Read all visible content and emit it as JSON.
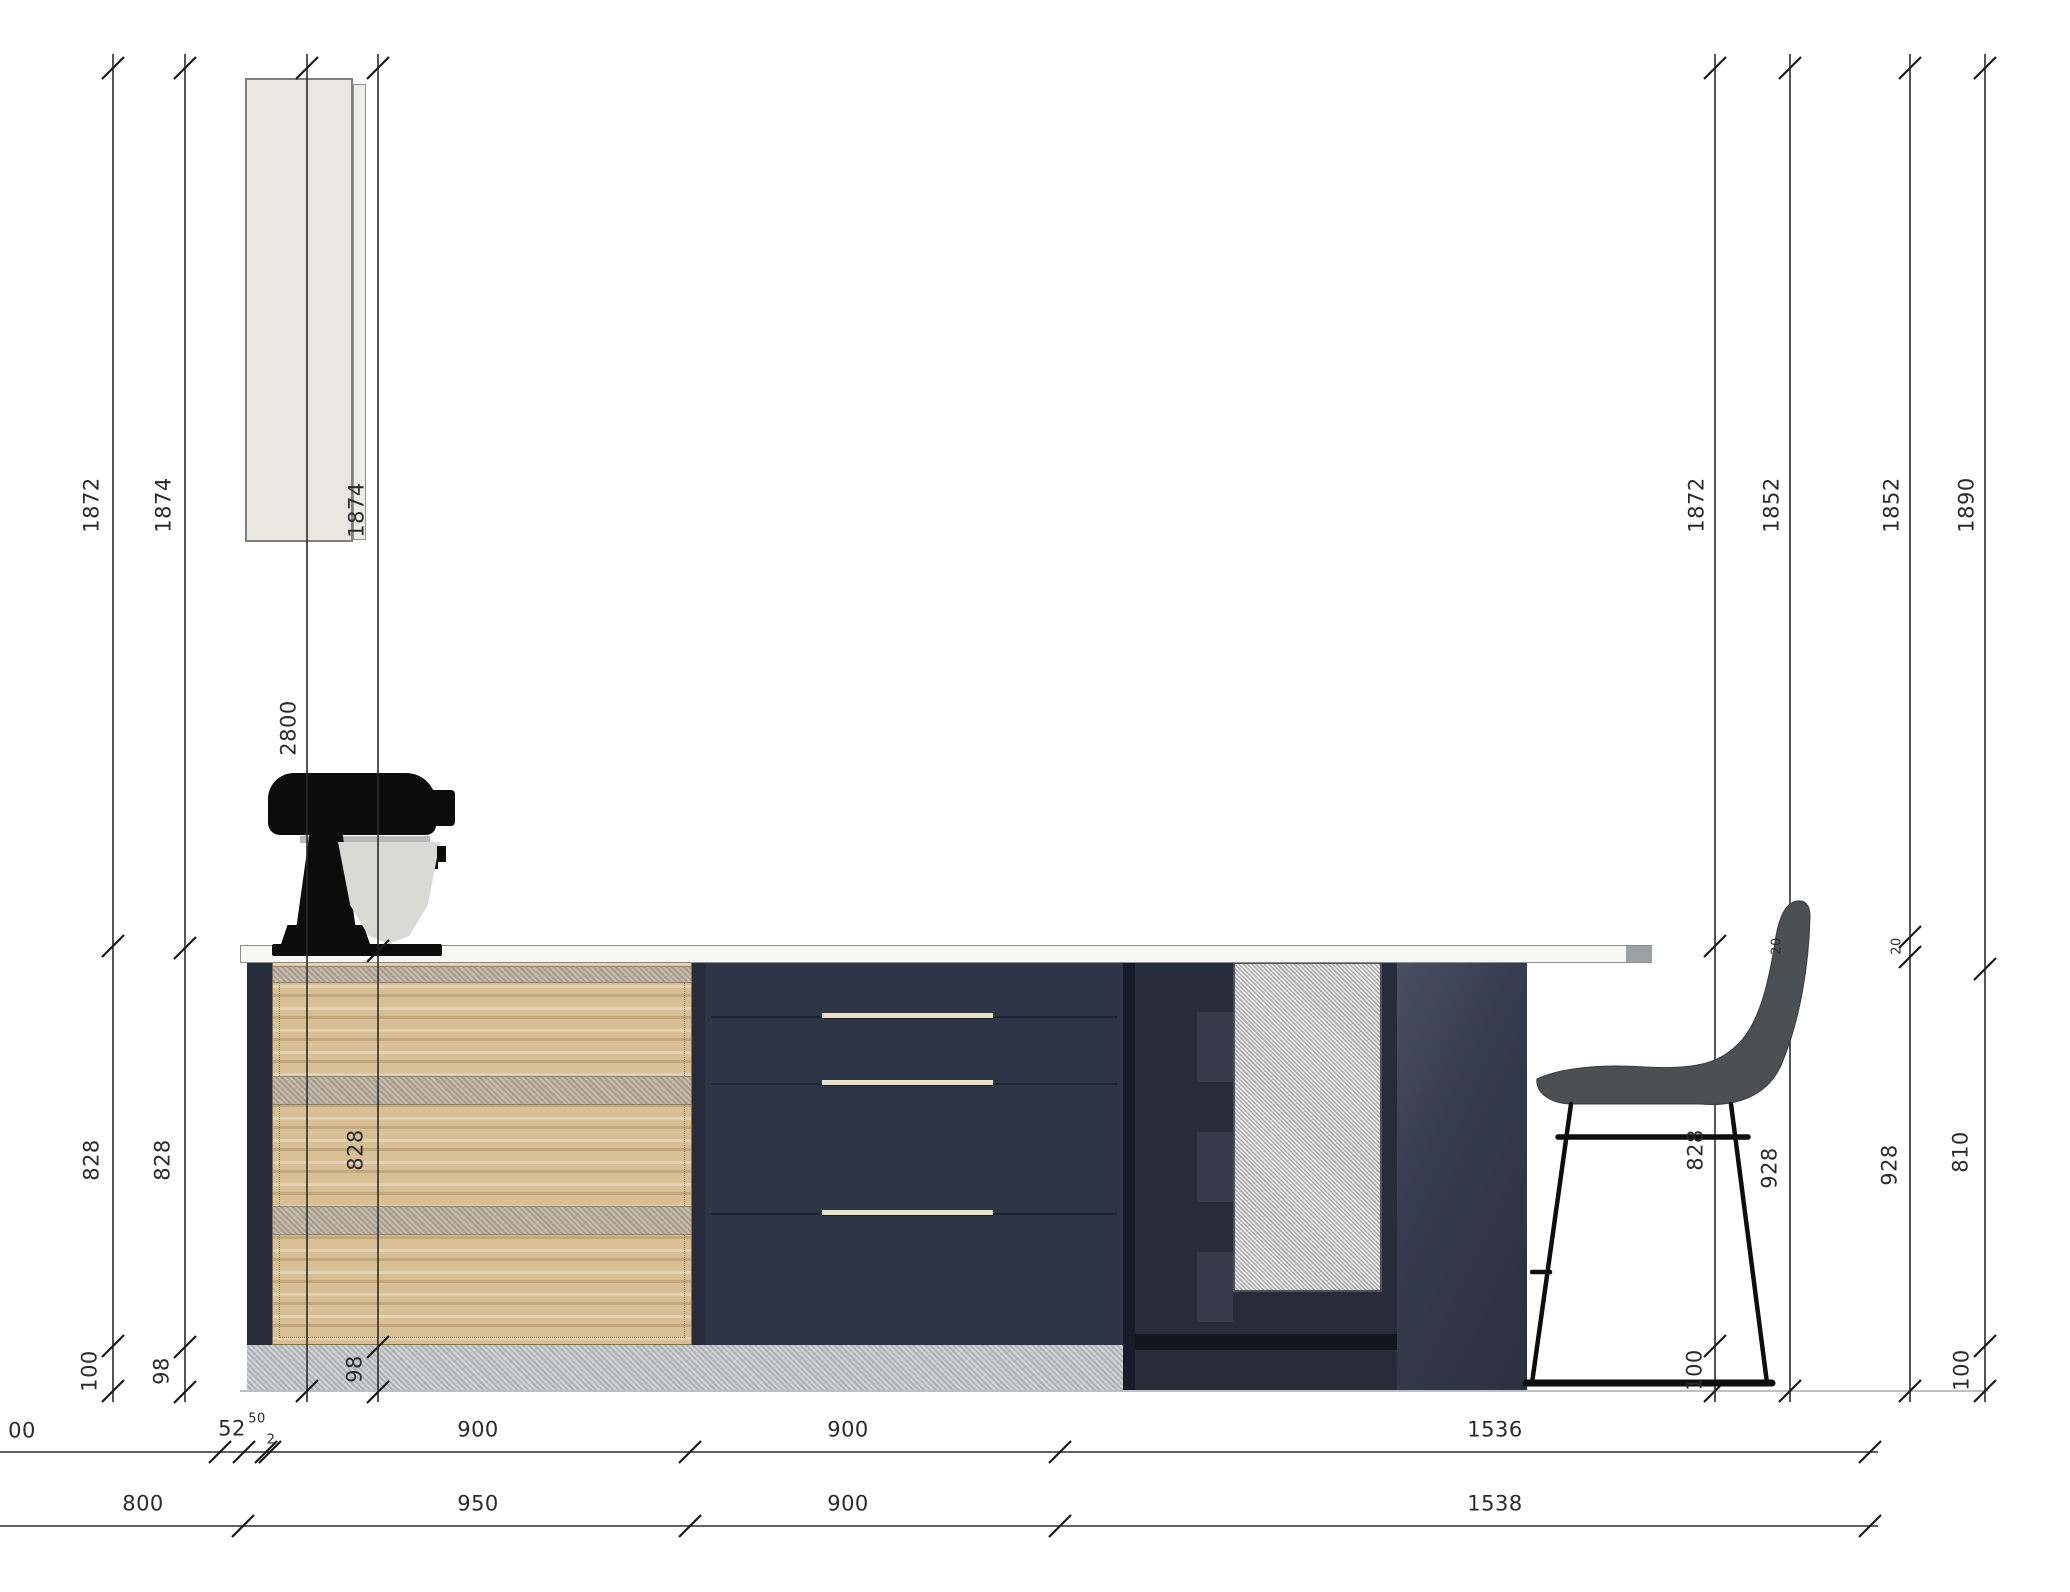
{
  "document": {
    "type": "kitchen-island-elevation-drawing",
    "view": "side-elevation"
  },
  "colors": {
    "cabinet_navy": "#2e3546",
    "wood_front": "#d8c094",
    "countertop": "#f7f7f4",
    "plinth_gray": "#b8bbbe",
    "mesh_panel": "#c8c8c8",
    "wall_unit": "#e8e8e1",
    "dimension_ink": "#2b2b2b"
  },
  "objects": {
    "wall_cabinet": "tall wall cabinet",
    "appliance": "stand mixer",
    "seating": "bar stool",
    "fronts": [
      "wood drawer front",
      "navy drawer stack",
      "mesh cabinet door",
      "end panel"
    ]
  },
  "structure": {
    "vertical_chains_left": [
      [
        "1872",
        "828",
        "100"
      ],
      [
        "1874",
        "828",
        "98"
      ],
      [
        "2800"
      ],
      [
        "1874",
        "828",
        "98"
      ]
    ],
    "vertical_chains_right": [
      [
        "1872",
        "828",
        "100"
      ],
      [
        "1852",
        "20",
        "928"
      ],
      [
        "1852",
        "20",
        "928"
      ],
      [
        "1890",
        "810",
        "100"
      ]
    ],
    "horizontal_rows": [
      [
        "00",
        "52",
        "50",
        "2",
        "900",
        "900",
        "1536"
      ],
      [
        "800",
        "950",
        "900",
        "1538"
      ]
    ]
  },
  "dim_labels": [
    {
      "text": "1872"
    },
    {
      "text": "828"
    },
    {
      "text": "100"
    },
    {
      "text": "1874"
    },
    {
      "text": "828"
    },
    {
      "text": "98"
    },
    {
      "text": "2800"
    },
    {
      "text": "1874"
    },
    {
      "text": "828"
    },
    {
      "text": "98"
    },
    {
      "text": "1872"
    },
    {
      "text": "828"
    },
    {
      "text": "100"
    },
    {
      "text": "1852"
    },
    {
      "text": "20"
    },
    {
      "text": "928"
    },
    {
      "text": "1852"
    },
    {
      "text": "20"
    },
    {
      "text": "928"
    },
    {
      "text": "1890"
    },
    {
      "text": "810"
    },
    {
      "text": "100"
    },
    {
      "text": "00"
    },
    {
      "text": "52"
    },
    {
      "text": "50"
    },
    {
      "text": "2"
    },
    {
      "text": "900"
    },
    {
      "text": "900"
    },
    {
      "text": "1536"
    },
    {
      "text": "800"
    },
    {
      "text": "950"
    },
    {
      "text": "900"
    },
    {
      "text": "1538"
    }
  ]
}
